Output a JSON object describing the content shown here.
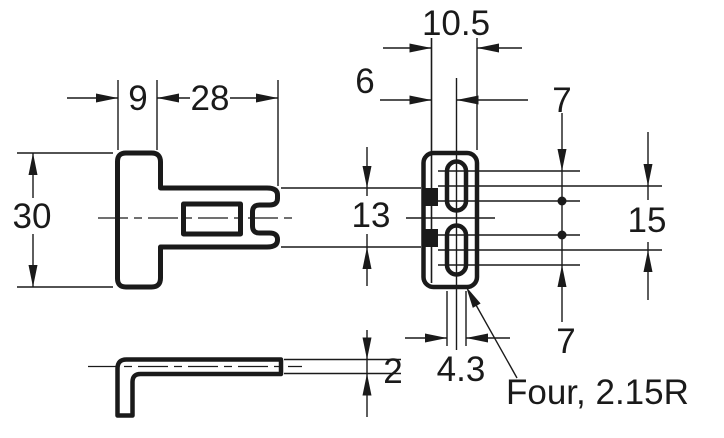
{
  "labels": {
    "side_view": {
      "top_width_left": "9",
      "top_width_right": "28",
      "height": "30"
    },
    "front_view": {
      "overall_width": "10.5",
      "slot_center_offset": "6",
      "top_arc_span": "7",
      "slot_pitch": "15",
      "bottom_arc_span": "7",
      "fork_span": "13",
      "slot_width": "4.3"
    },
    "bottom_view": {
      "thickness": "2"
    },
    "note": "Four, 2.15R"
  }
}
